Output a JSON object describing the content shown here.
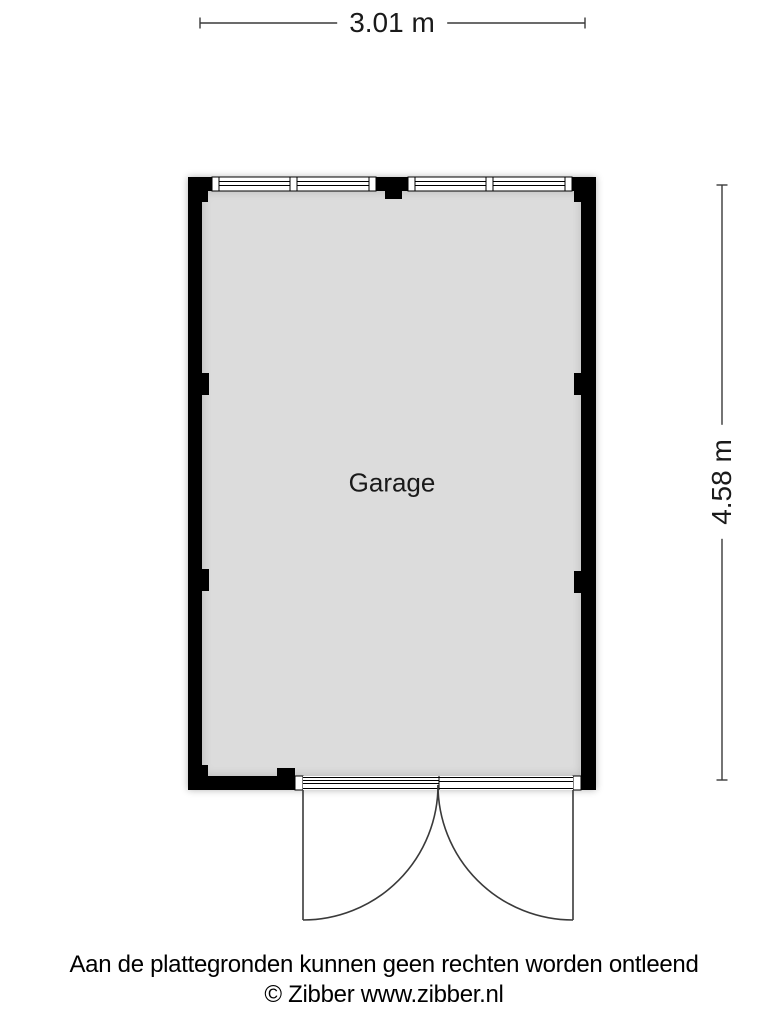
{
  "floor_plan": {
    "room": {
      "label": "Garage"
    },
    "dimensions": {
      "width": "3.01 m",
      "height": "4.58 m"
    }
  },
  "footer": {
    "disclaimer": "Aan de plattegronden kunnen geen rechten worden ontleend",
    "copyright": "© Zibber www.zibber.nl"
  },
  "colors": {
    "wall": "#000000",
    "floor": "#dcdcdc",
    "line": "#3a3a3a",
    "background": "#ffffff"
  }
}
